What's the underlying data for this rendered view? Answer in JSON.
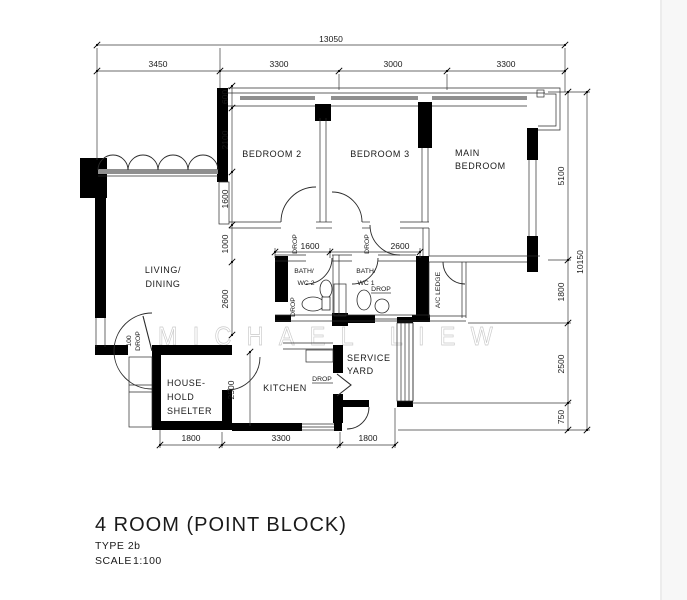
{
  "title_block": {
    "title": "4 ROOM (POINT BLOCK)",
    "type": "TYPE 2b",
    "scale_label": "SCALE",
    "scale_value": "1:100"
  },
  "watermark": "MICHAEL LIEW",
  "rooms": {
    "living_line1": "LIVING/",
    "living_line2": "DINING",
    "bedroom2": "BEDROOM 2",
    "bedroom3": "BEDROOM 3",
    "main_line1": "MAIN",
    "main_line2": "BEDROOM",
    "bath2_line1": "BATH/",
    "bath2_line2": "WC 2",
    "bath1_line1": "BATH/",
    "bath1_line2": "WC 1",
    "kitchen": "KITCHEN",
    "service_line1": "SERVICE",
    "service_line2": "YARD",
    "household_line1": "HOUSE-",
    "household_line2": "HOLD",
    "household_line3": "SHELTER",
    "ac_ledge": "A/C LEDGE"
  },
  "dimensions": {
    "top_overall": "13050",
    "top_segments": [
      "3450",
      "3300",
      "3000",
      "3300"
    ],
    "left_chain": [
      "600",
      "2100",
      "1600",
      "1000",
      "2600"
    ],
    "kitchen_depth": "2500",
    "bottom_segments": [
      "1800",
      "3300",
      "1800"
    ],
    "right_chain": [
      "5100",
      "1800",
      "2500",
      "750"
    ],
    "right_overall": "10150",
    "bath2_width": "1600",
    "bath1_width": "2600",
    "entrance_drop": "100"
  },
  "annotations": {
    "drop": "DROP"
  }
}
